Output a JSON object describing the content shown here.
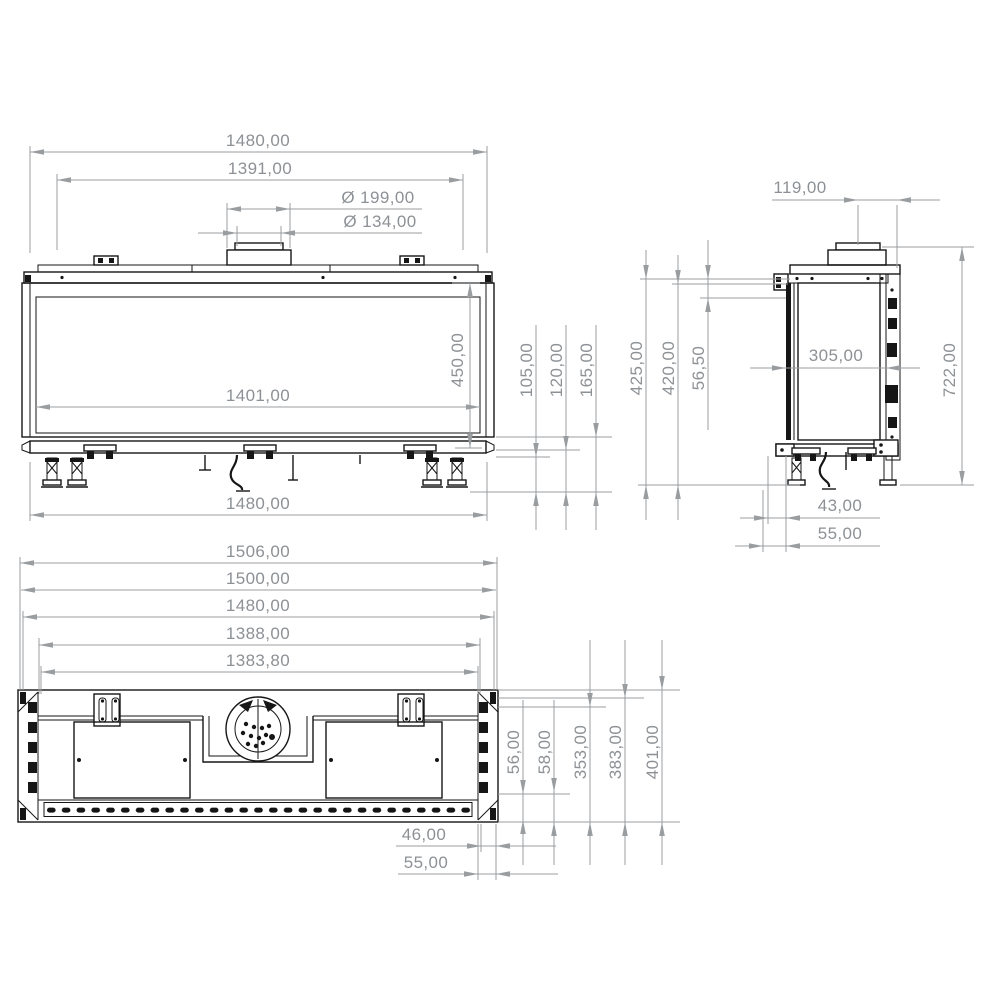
{
  "drawing": {
    "type": "technical-dimension-drawing",
    "line_color": "#161616",
    "dim_color": "#9a9da0",
    "views": {
      "front": {
        "overall_top": "1480,00",
        "inner_top": "1391,00",
        "flue_outer": "Ø 199,00",
        "flue_inner": "Ø 134,00",
        "glass_width": "1401,00",
        "glass_height": "450,00",
        "base_width": "1480,00",
        "offset_a": "105,00",
        "offset_b": "120,00",
        "offset_c": "165,00"
      },
      "side": {
        "flue_offset": "119,00",
        "height_a": "425,00",
        "height_b": "420,00",
        "top_gap": "56,50",
        "depth": "305,00",
        "overall_height": "722,00",
        "foot_a": "43,00",
        "foot_b": "55,00"
      },
      "plan": {
        "width_a": "1506,00",
        "width_b": "1500,00",
        "width_c": "1480,00",
        "width_d": "1388,00",
        "width_e": "1383,80",
        "depth_a": "56,00",
        "depth_b": "58,00",
        "depth_c": "353,00",
        "depth_d": "383,00",
        "depth_e": "401,00",
        "edge_a": "46,00",
        "edge_b": "55,00"
      }
    }
  }
}
